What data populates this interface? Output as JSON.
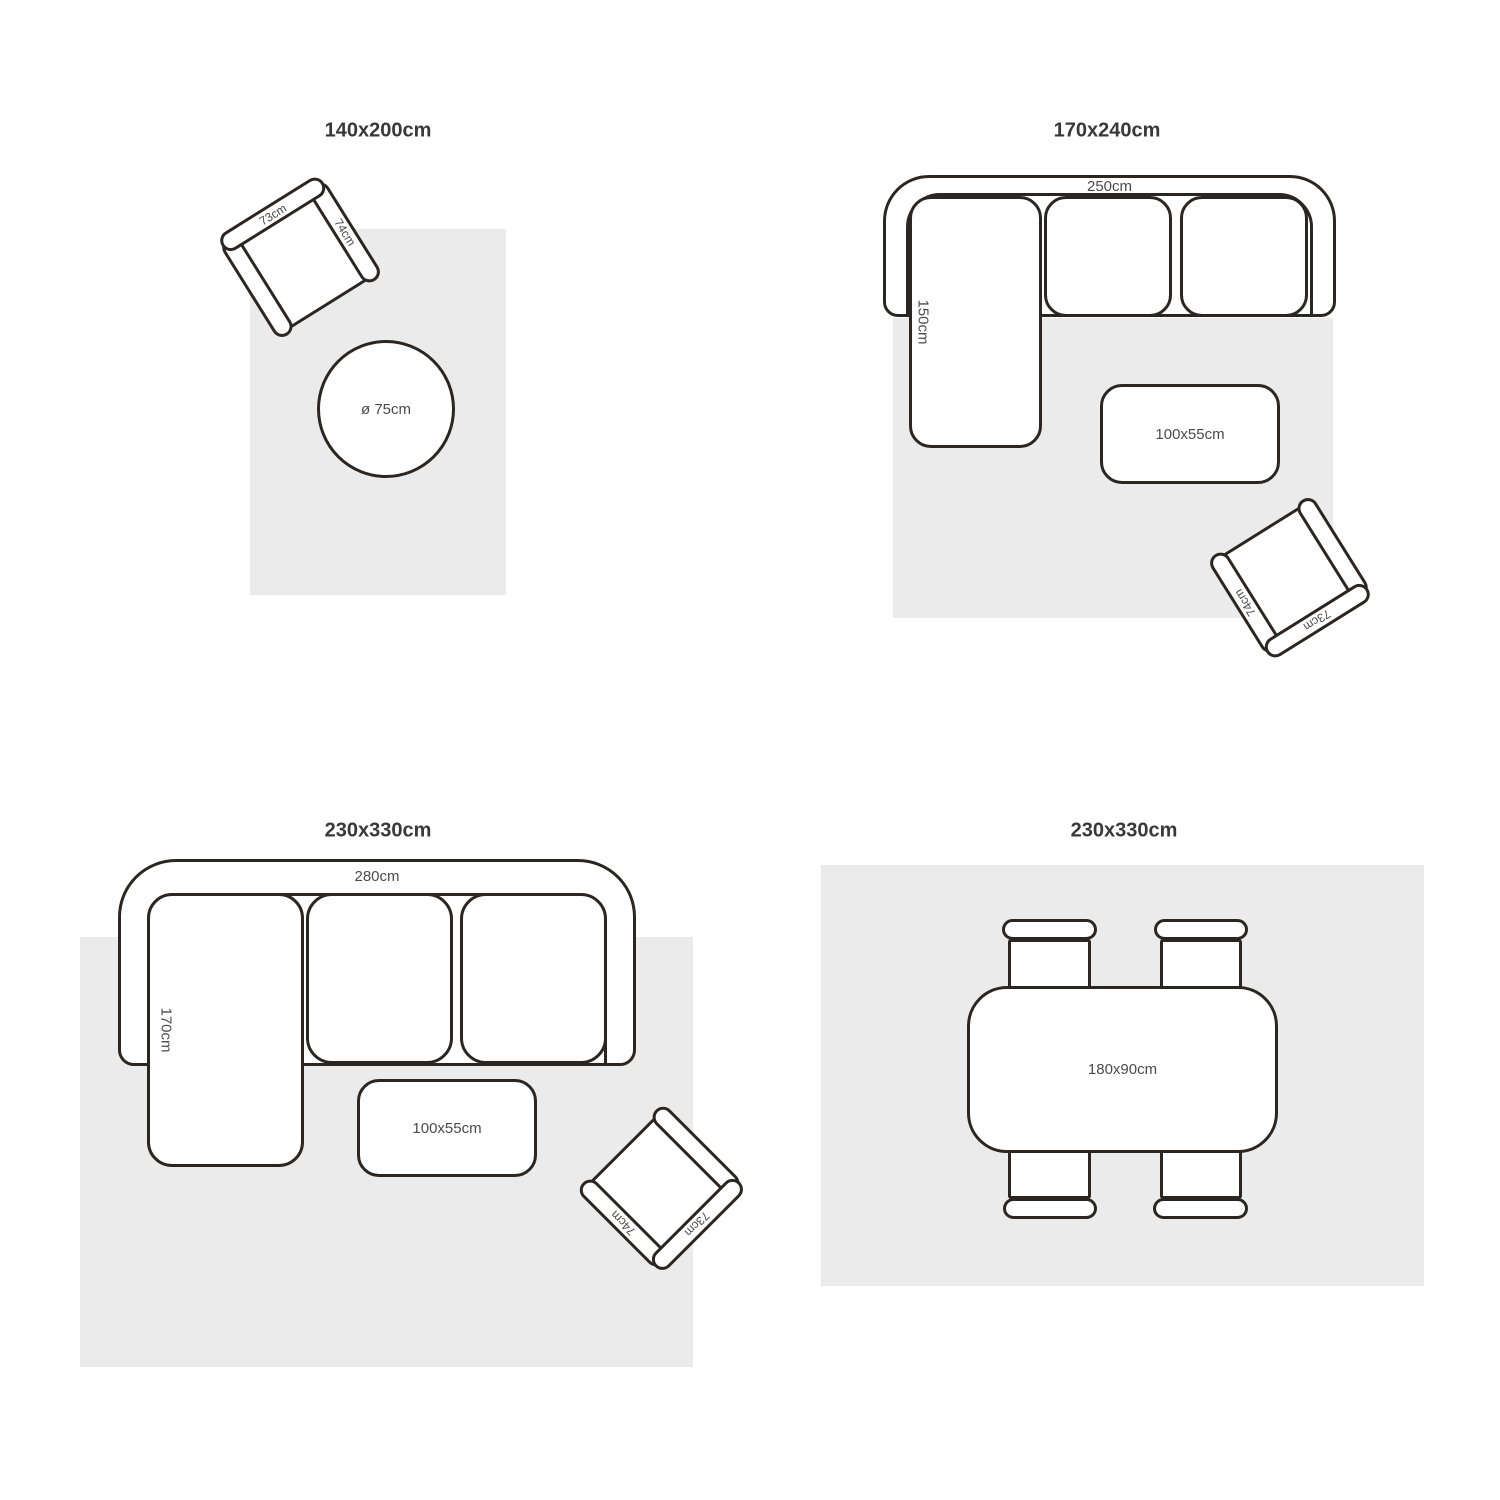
{
  "colors": {
    "background": "#ffffff",
    "rug": "#ebebeb",
    "outline": "#2b2622",
    "title_text": "#383838",
    "dimension_text": "#4a4a4a"
  },
  "quadrants": {
    "top_left": {
      "title": "140x200cm",
      "armchair": {
        "back": "73cm",
        "arm": "74cm"
      },
      "round_table": "ø 75cm"
    },
    "top_right": {
      "title": "170x240cm",
      "sofa": {
        "width": "250cm",
        "depth": "150cm"
      },
      "coffee_table": "100x55cm",
      "armchair": {
        "back": "73cm",
        "arm": "74cm"
      }
    },
    "bottom_left": {
      "title": "230x330cm",
      "sofa": {
        "width": "280cm",
        "depth": "170cm"
      },
      "coffee_table": "100x55cm",
      "armchair": {
        "back": "73cm",
        "arm": "74cm"
      }
    },
    "bottom_right": {
      "title": "230x330cm",
      "dining_table": "180x90cm"
    }
  }
}
